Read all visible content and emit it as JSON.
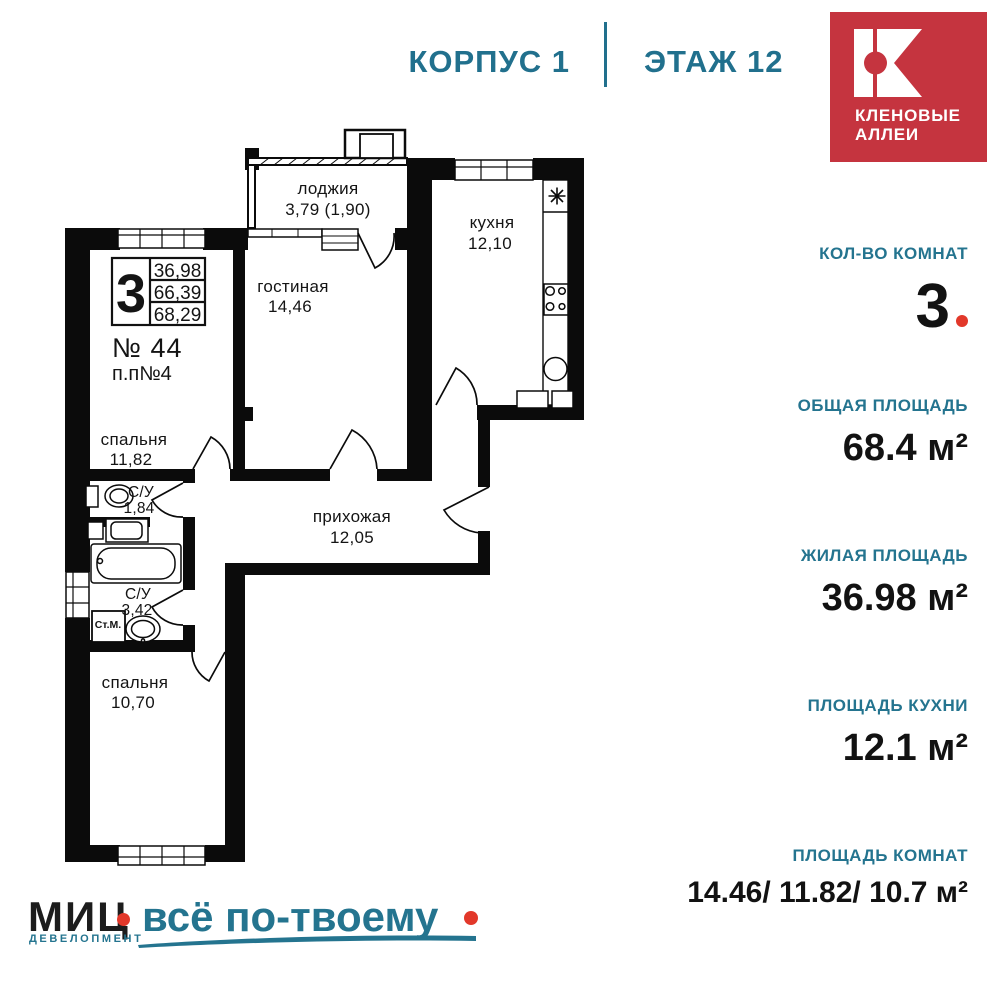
{
  "header": {
    "building": "КОРПУС 1",
    "floor": "ЭТАЖ 12"
  },
  "brand": {
    "line1": "КЛЕНОВЫЕ",
    "line2": "АЛЛЕИ"
  },
  "plan": {
    "apartment_number": "№ 44",
    "plan_code": "п.п№4",
    "info_box": {
      "rooms": "3",
      "living": "36,98",
      "usable": "66,39",
      "total": "68,29"
    },
    "rooms": [
      {
        "name": "лоджия",
        "area": "3,79 (1,90)"
      },
      {
        "name": "кухня",
        "area": "12,10"
      },
      {
        "name": "гостиная",
        "area": "14,46"
      },
      {
        "name": "спальня",
        "area": "11,82"
      },
      {
        "name": "С/У",
        "area": "1,84"
      },
      {
        "name": "прихожая",
        "area": "12,05"
      },
      {
        "name": "С/У",
        "area": "3,42"
      },
      {
        "name": "спальня",
        "area": "10,70"
      }
    ],
    "washing_machine": "Ст.М."
  },
  "sidebar": {
    "stats": [
      {
        "label": "КОЛ-ВО КОМНАТ",
        "value": "3"
      },
      {
        "label": "ОБЩАЯ ПЛОЩАДЬ",
        "value": "68.4 м²"
      },
      {
        "label": "ЖИЛАЯ ПЛОЩАДЬ",
        "value": "36.98 м²"
      },
      {
        "label": "ПЛОЩАДЬ КУХНИ",
        "value": "12.1 м²"
      },
      {
        "label": "ПЛОЩАДЬ КОМНАТ",
        "value": "14.46/ 11.82/ 10.7 м²"
      }
    ]
  },
  "footer": {
    "brand": "МИЦ",
    "division": "ДЕВЕЛОПМЕНТ",
    "slogan": "всё по-твоему"
  },
  "colors": {
    "teal": "#24748f",
    "brand_red": "#c5343f",
    "accent_red": "#e2382a",
    "walls": "#0b0b0b"
  }
}
